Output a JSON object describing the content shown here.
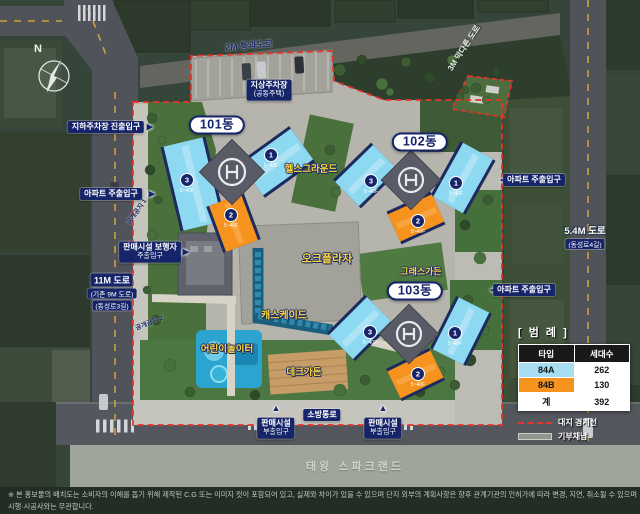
{
  "colors": {
    "navy": "#16246a",
    "tower_blue": "#8ed9f2",
    "tower_orange": "#f6921e",
    "boundary_red": "#e8332a",
    "label_yellow": "#ffd83d",
    "road": "#50535a",
    "pavement": "#b6b5ad",
    "green": "#4a713c",
    "green_dark": "#2e3e2c",
    "band_gray": "#a0a59c"
  },
  "compass": {
    "label": "N"
  },
  "icons": {
    "arrow_right": "▶",
    "arrow_left": "◀",
    "arrow_up": "▲"
  },
  "roads": {
    "top": "2M 통과도로",
    "dead_end": "3M 막다른 도로",
    "left_line1": "11M 도로",
    "left_line2": "(기존 9M 도로)",
    "left_line3": "(동성로3길)",
    "right_line1": "5.4M 도로",
    "right_line2": "(동성로4길)",
    "fire_lane": "소방통로"
  },
  "entries": {
    "underground": "지하주차장 진출입구",
    "apt_left": "아파트 주출입구",
    "apt_right_top": "아파트 주출입구",
    "apt_right_bottom": "아파트 주출입구",
    "retail_ped_line1": "판매시설 보행자",
    "retail_ped_line2": "주출입구",
    "retail_sub_line1": "판매시설",
    "retail_sub_line2": "부출입구"
  },
  "areas": {
    "parking_line1": "지상주차장",
    "parking_line2": "(공동주택)",
    "health": "헬스그라운드",
    "oak": "오크플라자",
    "grass": "그래스가든",
    "cascade": "캐스케이드",
    "playground": "어린이놀이터",
    "deck": "데크가든",
    "open1": "공개공지 1",
    "open2": "공개공지 2",
    "south_band": "태왕 스파크랜드"
  },
  "buildings": [
    {
      "name": "101동",
      "units": [
        {
          "no": "3",
          "floors": "5~40F"
        },
        {
          "no": "1",
          "floors": "5~40F"
        },
        {
          "no": "2",
          "floors": "5~40F"
        }
      ]
    },
    {
      "name": "102동",
      "units": [
        {
          "no": "3",
          "floors": "5~40F"
        },
        {
          "no": "1",
          "floors": "5~40F"
        },
        {
          "no": "2",
          "floors": "5~40F"
        }
      ]
    },
    {
      "name": "103동",
      "units": [
        {
          "no": "3",
          "floors": "5~40F"
        },
        {
          "no": "1",
          "floors": "5~40F"
        },
        {
          "no": "2",
          "floors": "5~40F"
        }
      ]
    }
  ],
  "legend": {
    "title": "[ 범 례 ]",
    "headers": [
      "타입",
      "세대수"
    ],
    "rows": [
      {
        "type": "84A",
        "count": "262",
        "color": "#a6ddf3"
      },
      {
        "type": "84B",
        "count": "130",
        "color": "#f6921e"
      },
      {
        "type": "계",
        "count": "392",
        "color": "#ffffff"
      }
    ],
    "boundary": "대지 경계선",
    "donation": "기부채납"
  },
  "footnotes": {
    "line1": "※ 본 홍보물의 배치도는 소비자의 이해를 돕기 위해 제작된 C.G 또는 이미지 컷이 포함되어 있고, 실제와 차이가 있을 수 있으며 단지 외부의 계획사항은 향후 관계기관의 인허가에 따라 변경, 지연, 취소될 수 있으며 시행·시공사와는 무관합니다.",
    "line2": "※ 사업지 남측에 스파크랜드가 위치하오니 계약 전에 반드시 확인 부탁드립니다."
  }
}
